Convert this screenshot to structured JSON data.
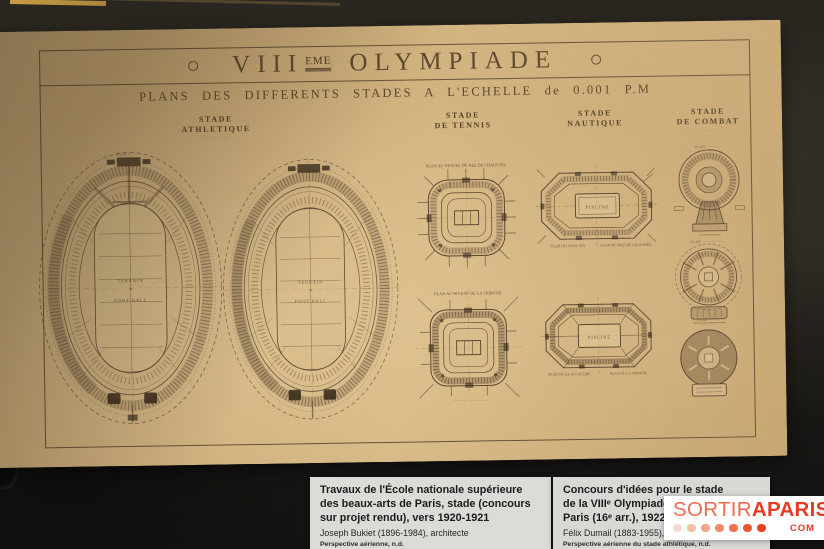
{
  "poster": {
    "ornament": "",
    "title_roman": "VIII",
    "title_sup": "EME",
    "title_word": "OLYMPIADE",
    "subtitle": "PLANS DES DIFFERENTS STADES A L'ECHELLE de 0.001 P.M",
    "sections": [
      {
        "line1": "STADE",
        "line2": "ATHLETIQUE",
        "note": "······ ·········"
      },
      {
        "line1": "STADE",
        "line2": "DE TENNIS",
        "note": "··· ·········"
      },
      {
        "line1": "STADE",
        "line2": "NAUTIQUE",
        "note": "··· ·········"
      },
      {
        "line1": "STADE",
        "line2": "DE COMBAT",
        "note": "··· ·········"
      }
    ],
    "oval": {
      "caption": "PLAN ·· ···· ···",
      "terrain": "TERRAIN",
      "de": "DE",
      "football": "FOOT-BALL"
    },
    "tennis": {
      "caption1": "PLAN AU NIVEAU DU REZ DE CHAUSSÉE",
      "caption2": "PLAN AU NIVEAU DE LA TRIBUNE",
      "caption2_bottom": "···· ·· ······ | ···· ·· ·····"
    },
    "nautique": {
      "pool": "PISCINE",
      "caption1a": "PLAN DU SOUS-SOL",
      "caption1b": "PLAN DU REZ DE CHAUSSÉE",
      "caption2a": "PLAN DE LA 1E GALERIE",
      "caption2b": "PLAN DE LA TRIBUNE"
    },
    "combat": {
      "caption1": "PLAN ·· ······ ···",
      "caption2": "PLAN ····· ·· ··· ·······",
      "caption3a": "PLAN ··· ······",
      "caption3b": "· ····· ······"
    }
  },
  "cards": {
    "left": {
      "title": "Travaux de l'École nationale supérieure des beaux-arts de Paris, stade (concours sur projet rendu), vers 1920-1921",
      "author": "Joseph Bukiet (1896-1984), architecte",
      "note": "Perspective aérienne, n.d."
    },
    "right": {
      "title1": "Concours d'idées pour le stade",
      "title2": "de la VIIIᵉ Olympiade, po",
      "title3": "Paris (16ᵉ arr.), 1922",
      "author": "Félix Dumail (1883-1955), archite",
      "note": "Perspective aérienne du stade athlétique, n.d.",
      "medium": "Encre et mine de plomb sur calque"
    }
  },
  "logo": {
    "sortir": "SORTIR",
    "aparis": "APARIS",
    "com": "COM",
    "dot_colors": [
      "#f7ddd0",
      "#f5c0a8",
      "#f2a488",
      "#f08a6a",
      "#ee7150",
      "#eb5838",
      "#e84023"
    ]
  }
}
